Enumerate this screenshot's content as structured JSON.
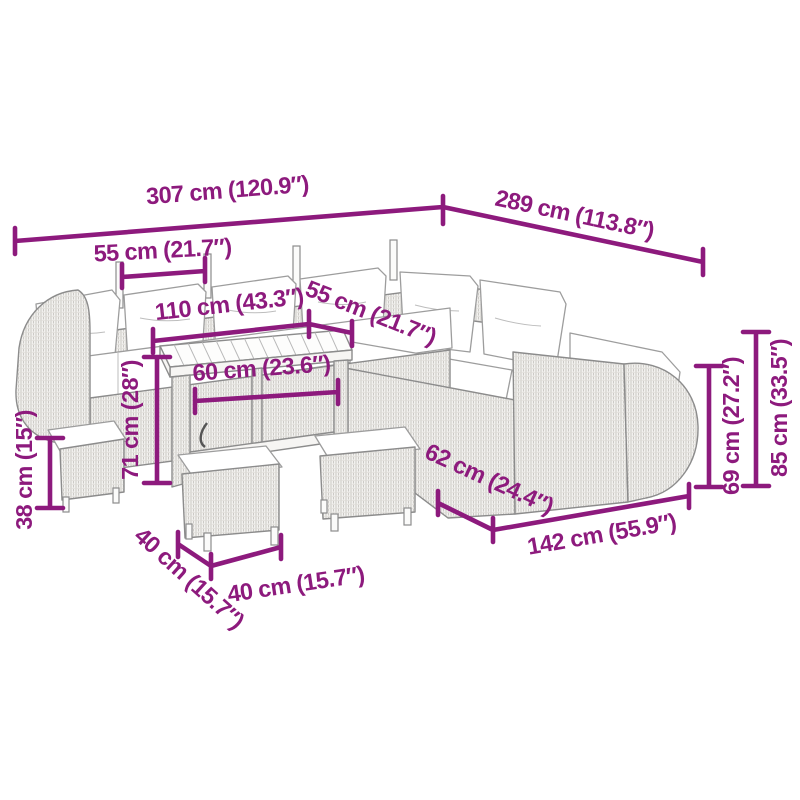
{
  "page": {
    "background": "#ffffff"
  },
  "diagram": {
    "type": "product-dimension-diagram",
    "subject": "garden lounge furniture set with dining table and stools",
    "accent_color": "#8D1A7D",
    "furniture_outline_color": "#8C8C8C",
    "dimensions": {
      "total_width": "307 cm (120.9″)",
      "total_depth": "289 cm (113.8″)",
      "seat_width": "55 cm (21.7″)",
      "table_length": "110 cm (43.3″)",
      "seat_depth": "55 cm (21.7″)",
      "table_depth": "60 cm (23.6″)",
      "table_height": "71 cm (28″)",
      "stool_height": "38 cm (15″)",
      "stool_depth": "40 cm (15.7″)",
      "stool_width": "40 cm (15.7″)",
      "sofa_depth": "62 cm (24.4″)",
      "sofa_length": "142 cm (55.9″)",
      "armrest_height": "69 cm (27.2″)",
      "backrest_height": "85 cm (33.5″)"
    }
  }
}
